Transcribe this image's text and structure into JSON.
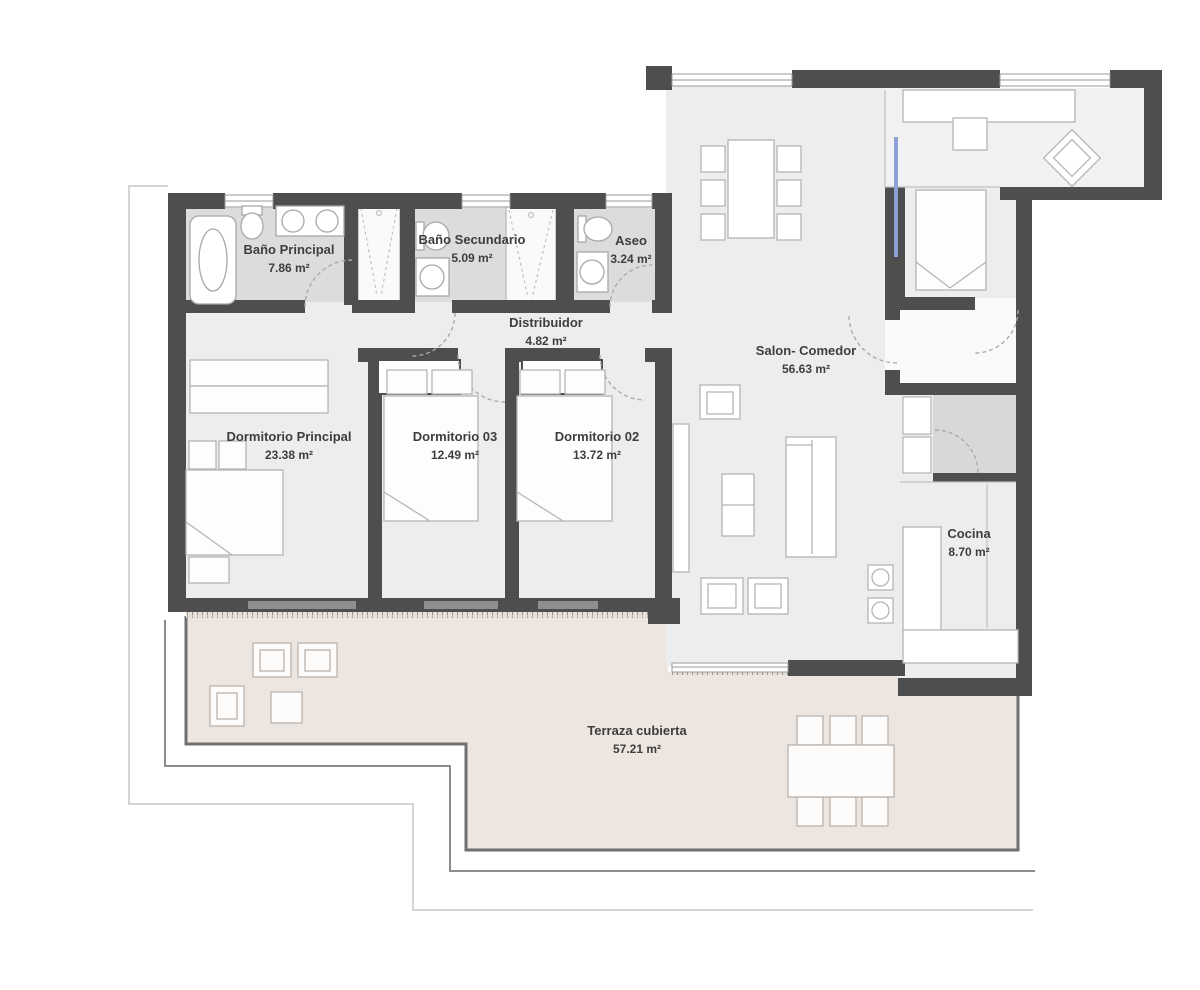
{
  "rooms": [
    {
      "id": "bano-principal",
      "name": "Baño Principal",
      "area": "7.86 m²"
    },
    {
      "id": "bano-secundario",
      "name": "Baño Secundario",
      "area": "5.09 m²"
    },
    {
      "id": "aseo",
      "name": "Aseo",
      "area": "3.24 m²"
    },
    {
      "id": "distribuidor",
      "name": "Distribuidor",
      "area": "4.82 m²"
    },
    {
      "id": "dormitorio-principal",
      "name": "Dormitorio Principal",
      "area": "23.38 m²"
    },
    {
      "id": "dormitorio-03",
      "name": "Dormitorio 03",
      "area": "12.49 m²"
    },
    {
      "id": "dormitorio-02",
      "name": "Dormitorio 02",
      "area": "13.72 m²"
    },
    {
      "id": "salon-comedor",
      "name": "Salon- Comedor",
      "area": "56.63 m²"
    },
    {
      "id": "cocina",
      "name": "Cocina",
      "area": "8.70 m²"
    },
    {
      "id": "terraza-cubierta",
      "name": "Terraza cubierta",
      "area": "57.21 m²"
    }
  ],
  "colors": {
    "wall": "#4e4e4e",
    "interior_floor": "#ededed",
    "bathroom_floor": "#dcdcdc",
    "vestibule_floor": "#d8d8d8",
    "terrace_floor": "#ece5e0",
    "terrace_border": "#707070",
    "furniture_stroke": "#b5b5b5",
    "door_arc": "#ababab",
    "glass_accent": "#8f9fd8",
    "label_text": "#3e3e3e"
  }
}
